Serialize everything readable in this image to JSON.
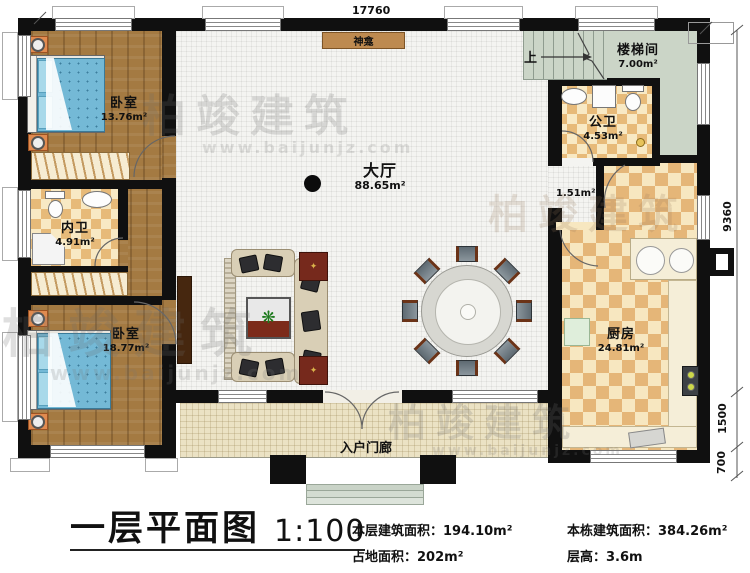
{
  "plan": {
    "dim_top": "17760",
    "dim_right_total": "9360",
    "dim_right_porch": "1500",
    "dim_right_steps": "700",
    "shrine_label": "神龛",
    "stairs_up_label": "上",
    "corridor_area": "1.51m²"
  },
  "rooms": {
    "bedroom1": {
      "label": "卧室",
      "area": "13.76m²"
    },
    "stairwell": {
      "label": "楼梯间",
      "area": "7.00m²"
    },
    "public_bath": {
      "label": "公卫",
      "area": "4.53m²"
    },
    "hall": {
      "label": "大厅",
      "area": "88.65m²"
    },
    "inner_bath": {
      "label": "内卫",
      "area": "4.91m²"
    },
    "bedroom2": {
      "label": "卧室",
      "area": "18.77m²"
    },
    "kitchen": {
      "label": "厨房",
      "area": "24.81m²"
    },
    "porch": {
      "label": "入户门廊"
    }
  },
  "title_block": {
    "title": "一层平面图",
    "scale": "1:100",
    "stat1_label": "本层建筑面积：",
    "stat1_value": "194.10m²",
    "stat2_label": "占地面积：",
    "stat2_value": "202m²",
    "stat3_label": "本栋建筑面积：",
    "stat3_value": "384.26m²",
    "stat4_label": "层高：",
    "stat4_value": "3.6m"
  },
  "watermark": {
    "brand": "柏竣建筑",
    "url": "www.baijunjz.com"
  },
  "colors": {
    "wall": "#101010",
    "wood_floor": "#a47a42",
    "checker_dark": "#e7ba79",
    "checker_light": "#f8e9c4",
    "stairwell_green": "#cbd5c7",
    "porch_tile": "#ebe2c4",
    "bed_blue": "#74b9d6",
    "rug_red": "#76291c",
    "shrine_brown": "#bd8a50"
  }
}
